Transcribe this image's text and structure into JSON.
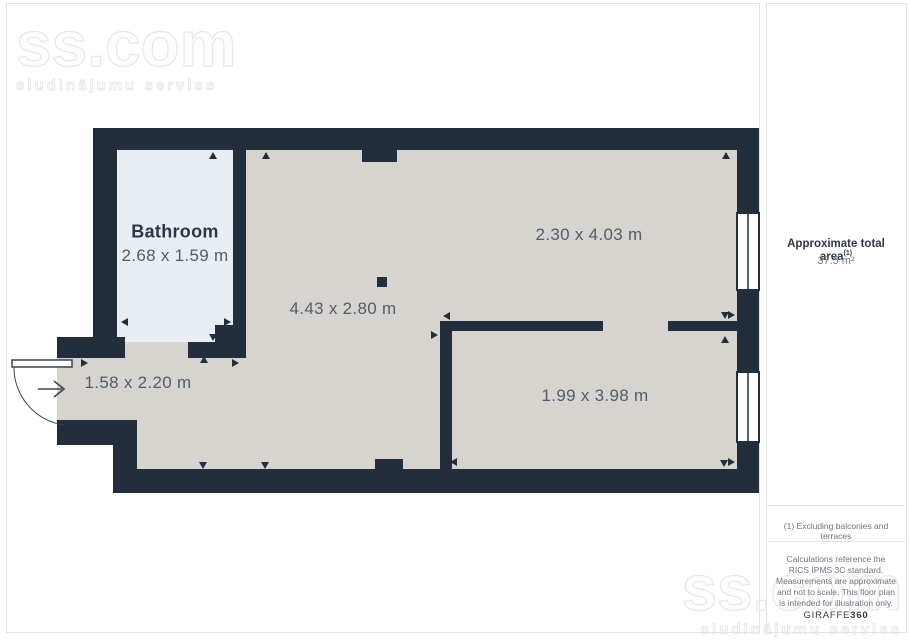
{
  "watermark": {
    "brand": "ss.com",
    "tagline": "sludinājumu serviss"
  },
  "plan": {
    "rooms": {
      "bathroom": {
        "name": "Bathroom",
        "dims": "2.68 x 1.59 m"
      },
      "living": {
        "dims": "4.43 x 2.80 m"
      },
      "top_right": {
        "dims": "2.30 x 4.03 m"
      },
      "bottom_right": {
        "dims": "1.99 x 3.98 m"
      },
      "hallway": {
        "dims": "1.58 x 2.20 m"
      }
    },
    "colors": {
      "wall": "#222e3c",
      "floor": "#d7d4d0",
      "bathroom_floor": "#e9edf4",
      "window": "#ffffff"
    }
  },
  "sidebar": {
    "area_label": "Approximate total area",
    "area_footnote_ref": "(1)",
    "area_value": "37.5 m²",
    "footnote": "(1) Excluding balconies and terraces",
    "disclaimer": "Calculations reference the RICS IPMS 3C standard. Measurements are approximate and not to scale. This floor plan is intended for illustration only.",
    "brand_name": "GIRAFFE",
    "brand_number": "360"
  }
}
